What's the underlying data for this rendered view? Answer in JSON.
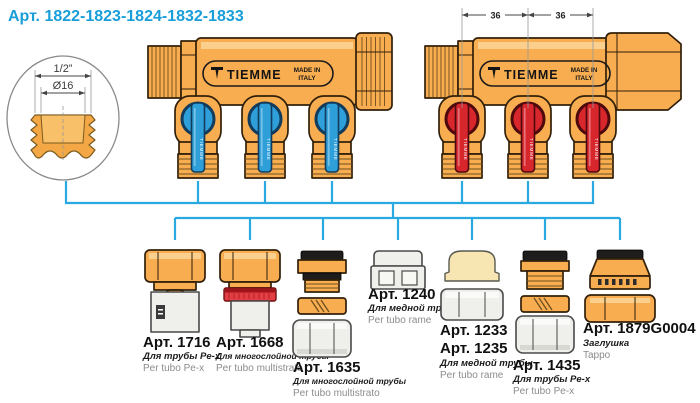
{
  "page": {
    "title": "Арт. 1822-1823-1824-1832-1833"
  },
  "detail": {
    "dim_outer": "1/2”",
    "dim_bore": "Ø16"
  },
  "dims": {
    "seg1": "36",
    "seg2": "36"
  },
  "brand": {
    "name": "TIEMME",
    "made_in_1": "MADE IN",
    "made_in_2": "ITALY",
    "handle_text": "TIEMME"
  },
  "fittings": [
    {
      "art": "Арт. 1716",
      "desc_ru": "Для трубы Pe-x",
      "desc_it": "Per tubo Pe-x"
    },
    {
      "art": "Арт. 1668",
      "desc_ru": "Для многослойной трубы",
      "desc_it": "Per tubo multistrato"
    },
    {
      "art": "Арт. 1635",
      "desc_ru": "Для многослойной трубы",
      "desc_it": "Per tubo multistrato"
    },
    {
      "art": "Арт. 1240",
      "desc_ru": "Для медной трубы",
      "desc_it": "Per tubo rame"
    },
    {
      "art": "Арт. 1233",
      "art2": "Арт. 1235",
      "desc_ru": "Для медной трубы",
      "desc_it": "Per tubo rame"
    },
    {
      "art": "Арт. 1435",
      "desc_ru": "Для трубы Pe-x",
      "desc_it": "Per tubo Pe-x"
    },
    {
      "art": "Арт. 1879G0004",
      "desc_ru": "Заглушка",
      "desc_it": "Tappo"
    }
  ],
  "colors": {
    "brass": "#F7AD50",
    "handle_blue": "#2E9FD9",
    "handle_red": "#D8262D",
    "connector_blue": "#2AA9E1",
    "title_blue": "#189ED9",
    "part_grey": "#EFEFEC",
    "ring_red": "#E23E44",
    "olive_cream": "#F7E5B2"
  }
}
